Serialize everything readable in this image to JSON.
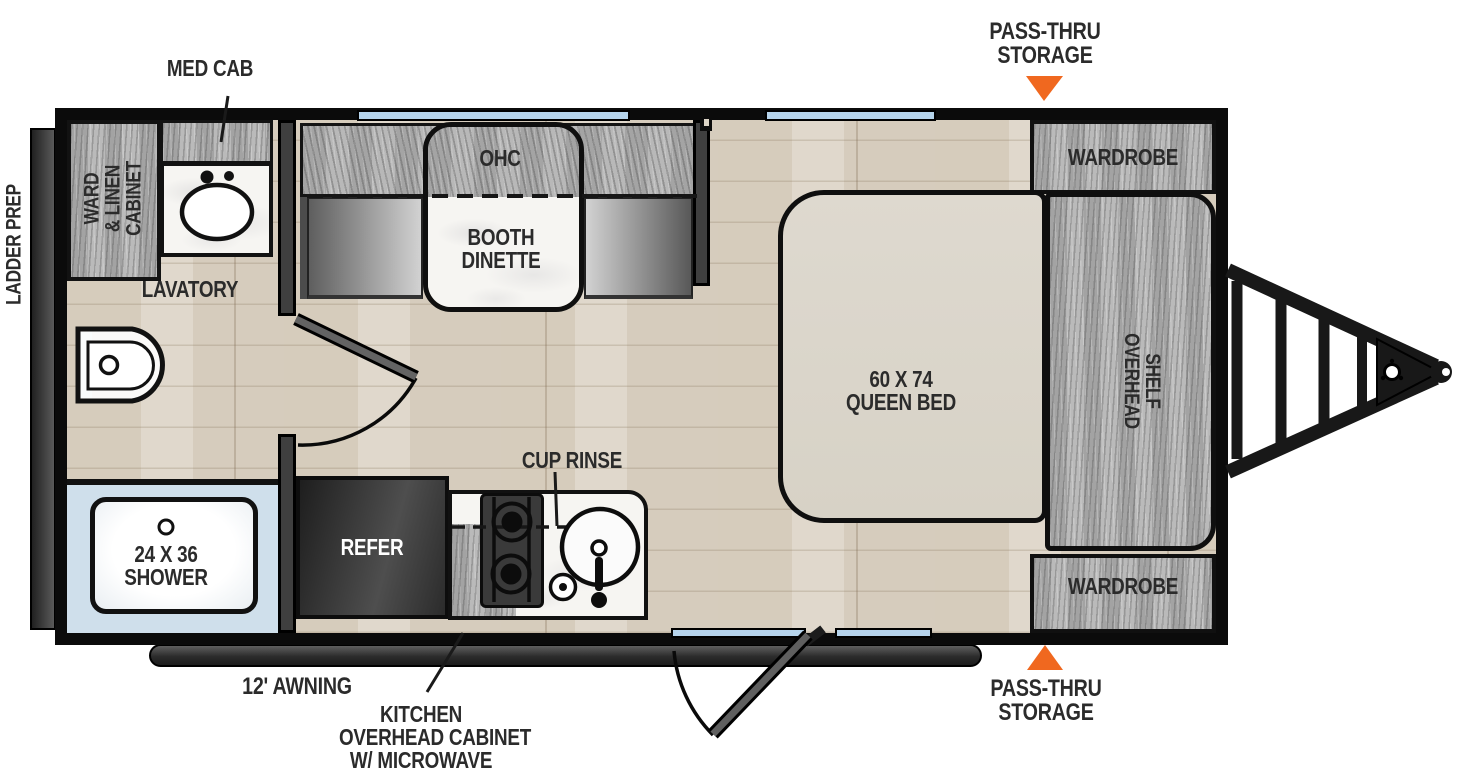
{
  "labels": {
    "med_cab": "MED CAB",
    "pass_thru_storage_top": [
      "PASS-THRU",
      "STORAGE"
    ],
    "ladder_prep": "LADDER PREP",
    "ward_linen_cabinet": [
      "WARD",
      "& LINEN",
      "CABINET"
    ],
    "lavatory": "LAVATORY",
    "overhead_cabinet": "OHC",
    "booth_dinette": [
      "BOOTH",
      "DINETTE"
    ],
    "wardrobe_top": "WARDROBE",
    "queen_bed": [
      "60 X 74",
      "QUEEN BED"
    ],
    "overhead_shelf": [
      "OVERHEAD",
      "SHELF"
    ],
    "wardrobe_bottom": "WARDROBE",
    "pass_thru_storage_bottom": [
      "PASS-THRU",
      "STORAGE"
    ],
    "cup_rinse": "CUP RINSE",
    "refer": "REFER",
    "shower": [
      "24 X 36",
      "SHOWER"
    ],
    "awning": "12' AWNING",
    "kitchen_overhead_cabinet": [
      "KITCHEN",
      "OVERHEAD CABINET",
      "W/ MICROWAVE"
    ]
  },
  "colors": {
    "accent_orange": "#f0681f",
    "window_blue": "#b5d3eb",
    "wall_black": "#0c0c0c",
    "shower_blue": "#cfdfeb"
  },
  "icons": {
    "pass_thru_arrow_top": "triangle-down",
    "pass_thru_arrow_bottom": "triangle-up"
  }
}
